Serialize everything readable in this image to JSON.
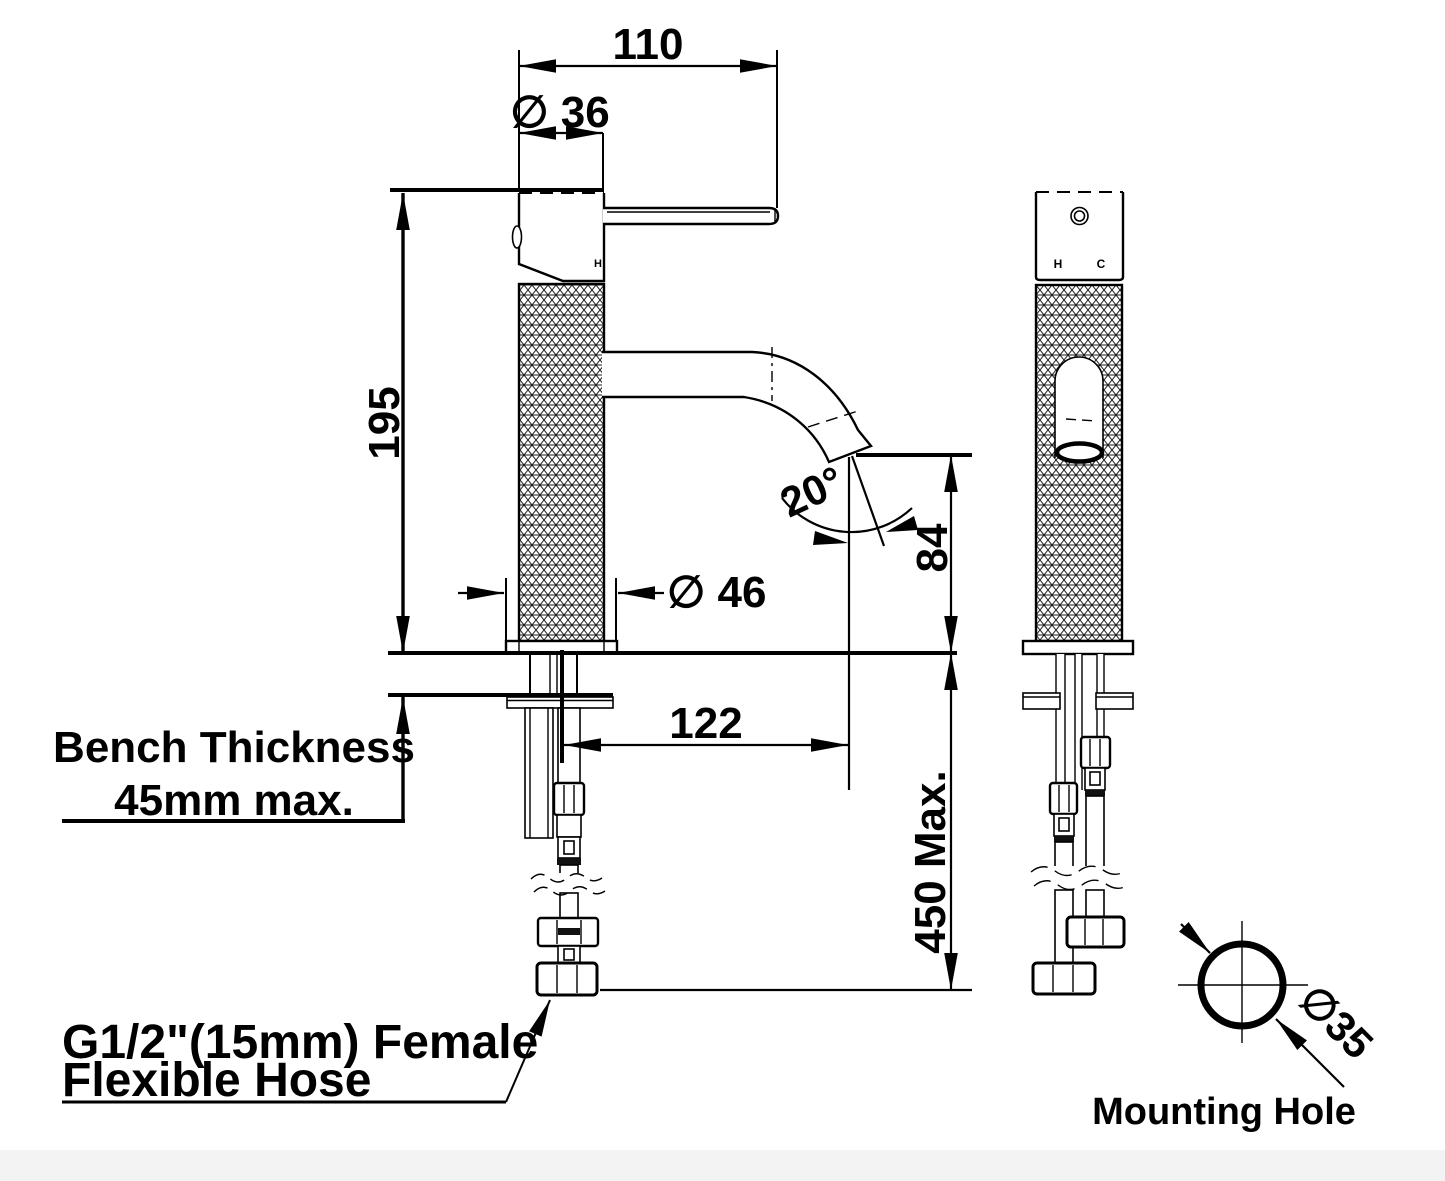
{
  "title": "Basin mixer tap installation drawing",
  "dimensions": {
    "handle_length": "110",
    "head_diameter": "∅ 36",
    "body_height": "195",
    "base_diameter": "∅ 46",
    "spout_angle": "20°",
    "spout_outlet_height": "84",
    "spout_reach": "122",
    "hose_drop": "450 Max.",
    "mounting_hole_diameter": "∅35"
  },
  "annotations": {
    "bench_thickness_line1": "Bench Thickness",
    "bench_thickness_line2": "45mm max.",
    "hose_label_line1": "G1/2\"(15mm) Female",
    "hose_label_line2": "Flexible Hose",
    "mounting_hole_label": "Mounting Hole"
  },
  "markings": {
    "hot_side": "H",
    "hot_front": "H",
    "cold_front": "C"
  },
  "colors": {
    "line": "#000000",
    "background": "#ffffff"
  }
}
